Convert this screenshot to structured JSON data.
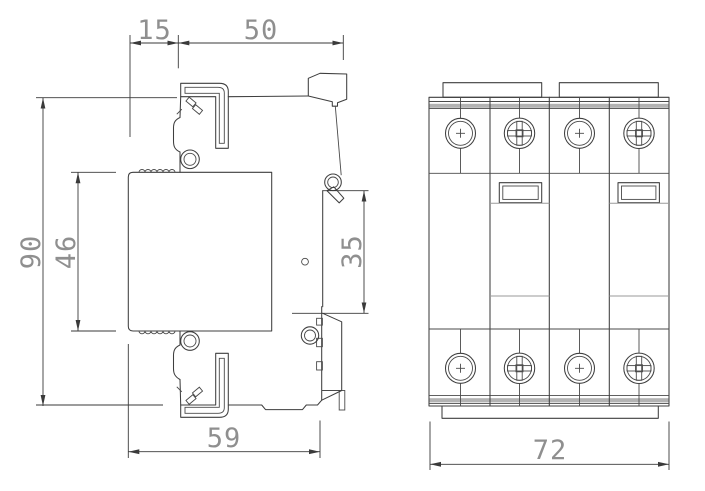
{
  "drawing": {
    "dimensions": {
      "d15": "15",
      "d50": "50",
      "d90": "90",
      "d46": "46",
      "d35": "35",
      "d59": "59",
      "d72": "72"
    },
    "colors": {
      "background": "#ffffff",
      "outline": "#3f3f3f",
      "dimension_line": "#3a3a3a",
      "dimension_text": "#8f8f8f",
      "shading": "#b3b3b3"
    }
  }
}
